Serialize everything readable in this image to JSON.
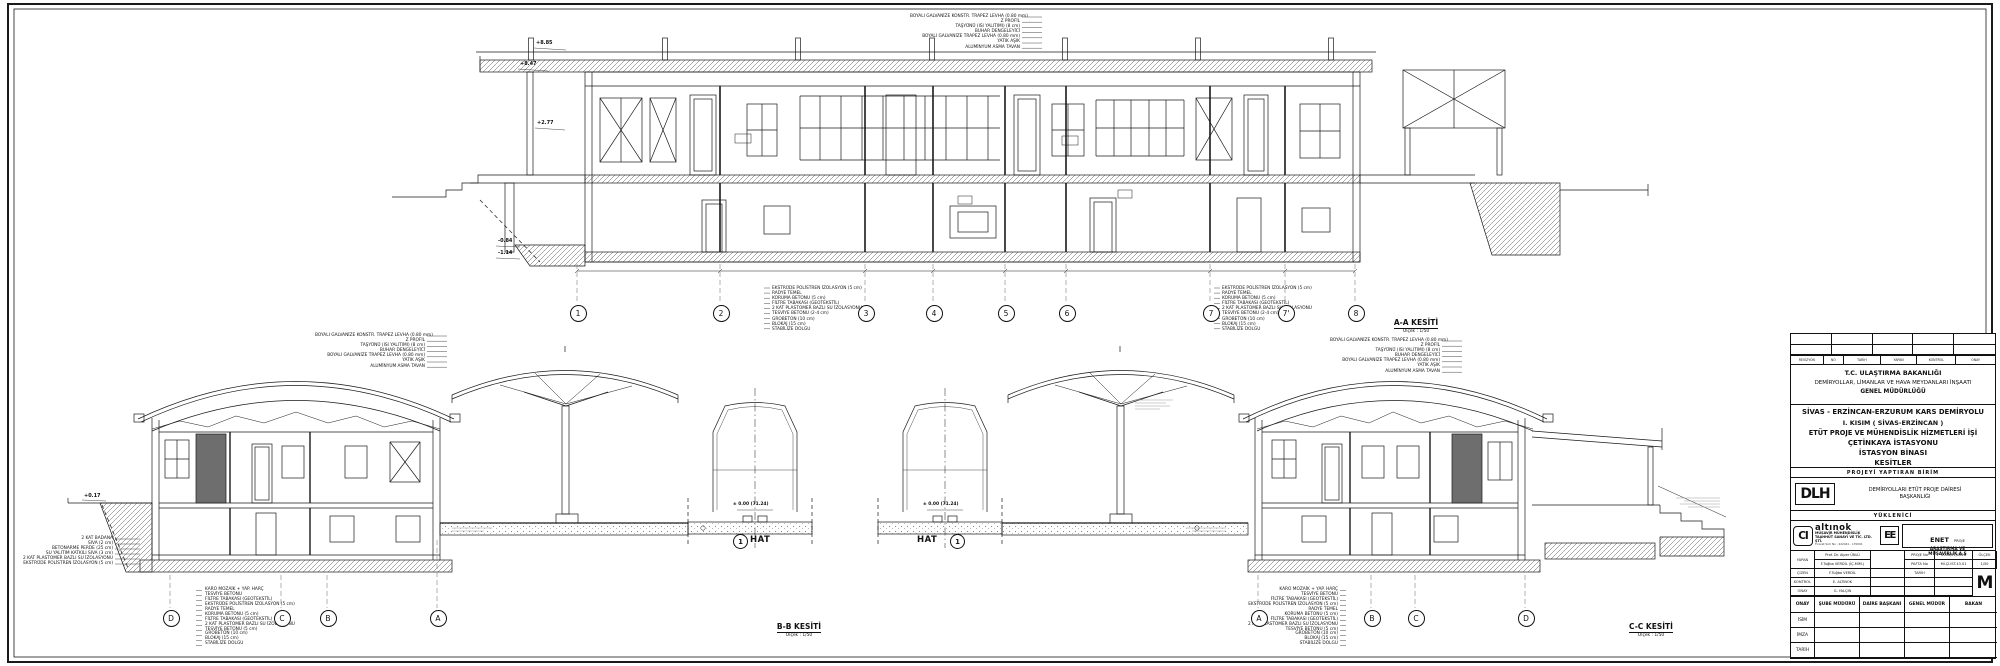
{
  "sheet": {
    "sections": {
      "aa": {
        "title": "A-A KESİTİ",
        "scale": "Ölçek : 1/50"
      },
      "bb": {
        "title": "B-B KESİTİ",
        "scale": "Ölçek : 1/50"
      },
      "cc": {
        "title": "C-C KESİTİ",
        "scale": "Ölçek : 1/50"
      }
    },
    "grid_top": [
      "1",
      "2",
      "3",
      "4",
      "5",
      "6",
      "7",
      "7'",
      "8"
    ],
    "grid_bottom_left": [
      "D",
      "C",
      "B",
      "A"
    ],
    "grid_bottom_right": [
      "A",
      "B",
      "C",
      "D"
    ],
    "hat": {
      "circle": "1",
      "word": "HAT"
    },
    "elevations": {
      "p885": "+8.85",
      "p847": "+8.47",
      "p277": "+2.77",
      "m084": "-0.84",
      "m114": "-1.14",
      "street": "+0.17",
      "rail": "± 0.00 (71.24)"
    },
    "annotations": {
      "roof": [
        "BOYALI GALVANİZE KONSTR. TRAPEZ LEVHA (0.80 mm)",
        "Z PROFİL",
        "TAŞYÜNÜ (ISI YALITIMI) (8 cm)",
        "BUHAR DENGELEYİCİ",
        "BOYALI GALVANİZE TRAPEZ LEVHA (0.80 mm)",
        "YATIK AŞIK",
        "ALUMİNYUM ASMA TAVAN"
      ],
      "foundation": [
        "EKSTRÜDE POLİSTREN İZOLASYON (5 cm)",
        "RADYE TEMEL",
        "KORUMA BETONU (5 cm)",
        "FİLTRE TABAKASI (GEOTEKSTİL)",
        "2 KAT PLASTOMER BAZLI SU İZOLASYONU",
        "TESVİYE BETONU (2-4 cm)",
        "GROBETON (10 cm)",
        "BLOKAJ (15 cm)",
        "STABİLİZE DOLGU"
      ],
      "floor": [
        "KARO MOZAİK + YAP. HARÇ",
        "TESVİYE BETONU",
        "FİLTRE TABAKASI (GEOTEKSTİL)",
        "EKSTRÜDE POLİSTREN İZOLASYON (5 cm)",
        "RADYE TEMEL",
        "KORUMA BETONU (5 cm)",
        "FİLTRE TABAKASI (GEOTEKSTİL)",
        "2 KAT PLASTOMER BAZLI SU İZOLASYONU",
        "TESVİYE BETONU (5 cm)",
        "GROBETON (10 cm)",
        "BLOKAJ (15 cm)",
        "STABİLİZE DOLGU"
      ],
      "wall": [
        "2 KAT BADANA",
        "SIVA (2 cm)",
        "BETONARME PERDE (25 cm)",
        "SU YALITIM KATKILI SIVA (3 cm)",
        "2 KAT PLASTOMER BAZLI SU İZOLASYONU",
        "EKSTRÜDE POLİSTREN İZOLASYON (5 cm)"
      ]
    }
  },
  "title_block": {
    "revision_header": [
      "REVİZYON",
      "NO",
      "TARİH",
      "YAPAN",
      "KONTROL",
      "ONAY"
    ],
    "ministry": [
      "T.C. ULAŞTIRMA  BAKANLIĞI",
      "DEMİRYOLLAR, LİMANLAR VE HAVA MEYDANLARI İNŞAATI",
      "GENEL  MÜDÜRLÜĞÜ"
    ],
    "project": [
      "SİVAS - ERZİNCAN-ERZURUM KARS  DEMİRYOLU",
      "I. KISIM ( SİVAS-ERZİNCAN )",
      "ETÜT  PROJE  VE  MÜHENDİSLİK  HİZMETLERİ  İŞİ",
      "ÇETİNKAYA İSTASYONU",
      "İSTASYON BİNASI",
      "KESİTLER"
    ],
    "yaptiran_header": "PROJEYİ  YAPTIRAN  BİRİM",
    "dlh_logo": "DLH",
    "yaptiran": [
      "DEMİRYOLLARI ETÜT PROJE DAİRESİ",
      "BAŞKANLIĞI"
    ],
    "yuklenici_header": "YÜKLENİCİ",
    "altinok": {
      "monogram": "CI",
      "name": "altınok",
      "line1": "MÜŞAVİR MÜHENDİSLİK",
      "line2": "TAAHHÜT SANAYİ VE TİC. LTD. ŞTİ.",
      "line3": "Ticaret Sicil No : 222441 - 170001"
    },
    "enet": {
      "monogram": "EE",
      "name": "ENET",
      "suffix": "PROJE",
      "line2": "ARAŞTIRMA VE",
      "line3": "MÜŞAVİRLİK A.Ş"
    },
    "signatures": {
      "yapan_label": "YAPAN",
      "yapan1": "Prof. Dr. Alper ÜNLÜ",
      "yapan2": "F.Tuğba VERDİL (İÇ.MİM.)",
      "cizen_label": "ÇİZEN",
      "cizen": "F.Tuğba VERDİL",
      "kontrol_label": "KONTROL",
      "kontrol": "E. ALTINOK",
      "onay_label": "ONAY",
      "onay": "G. YALÇIN",
      "proje_no_label": "PROJE No",
      "proje_no": "2006/21/0020",
      "pafta_no_label": "PAFTA No",
      "pafta_no": "Mİ.Çİ.İST.43.01",
      "tarih_label": "TARİH",
      "olcek_label": "ÖLÇEK",
      "olcek": "1/50",
      "m": "M"
    },
    "approval": {
      "onay": "ONAY",
      "sube": "ŞUBE MÜDÜRÜ",
      "daire": "DAİRE BAŞKANI",
      "genel": "GENEL MÜDÜR",
      "bakan": "BAKAN",
      "rows": [
        "İSİM",
        "İMZA",
        "TARİH"
      ]
    }
  }
}
